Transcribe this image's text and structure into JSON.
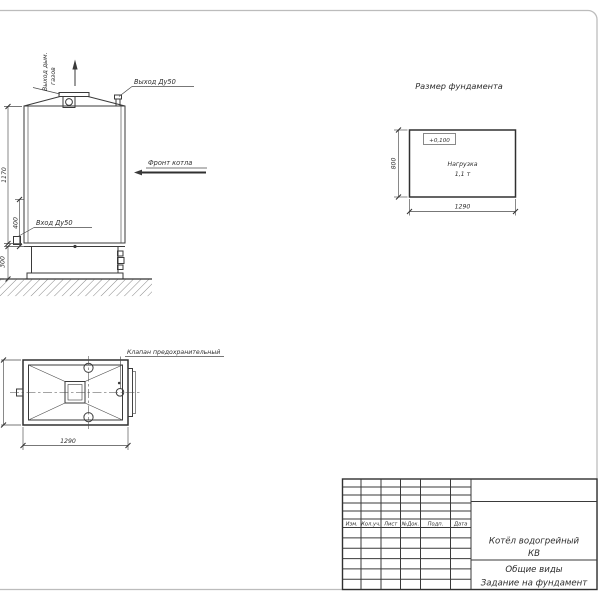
{
  "sheet": {
    "background": "#ffffff",
    "border_color": "#bcbcbc",
    "ink_color": "#3a3a3a"
  },
  "front_view": {
    "smoke_label_line1": "Выход дым.",
    "smoke_label_line2": "газов",
    "outlet_label": "Выход Ду50",
    "front_label": "Фронт котла",
    "inlet_label": "Вход Ду50",
    "dim_total_height": "1170",
    "dim_inlet_height": "400",
    "dim_base_height": "300"
  },
  "foundation_plan": {
    "title": "Размер фундамента",
    "elevation_mark": "+0,100",
    "load_line1": "Нагрузка",
    "load_line2": "1,1 т",
    "dim_depth": "800",
    "dim_width": "1290"
  },
  "top_view": {
    "valve_label": "Клапан предохранительный",
    "dim_width": "1290"
  },
  "title_block": {
    "columns": [
      "Изм.",
      "Кол.уч.",
      "Лист",
      "№Док.",
      "Подп.",
      "Дата"
    ],
    "product_line1": "Котёл водогрейный",
    "product_line2": "КВ",
    "doc_type_line1": "Общие виды",
    "doc_type_line2": "Задание на фундамент"
  }
}
